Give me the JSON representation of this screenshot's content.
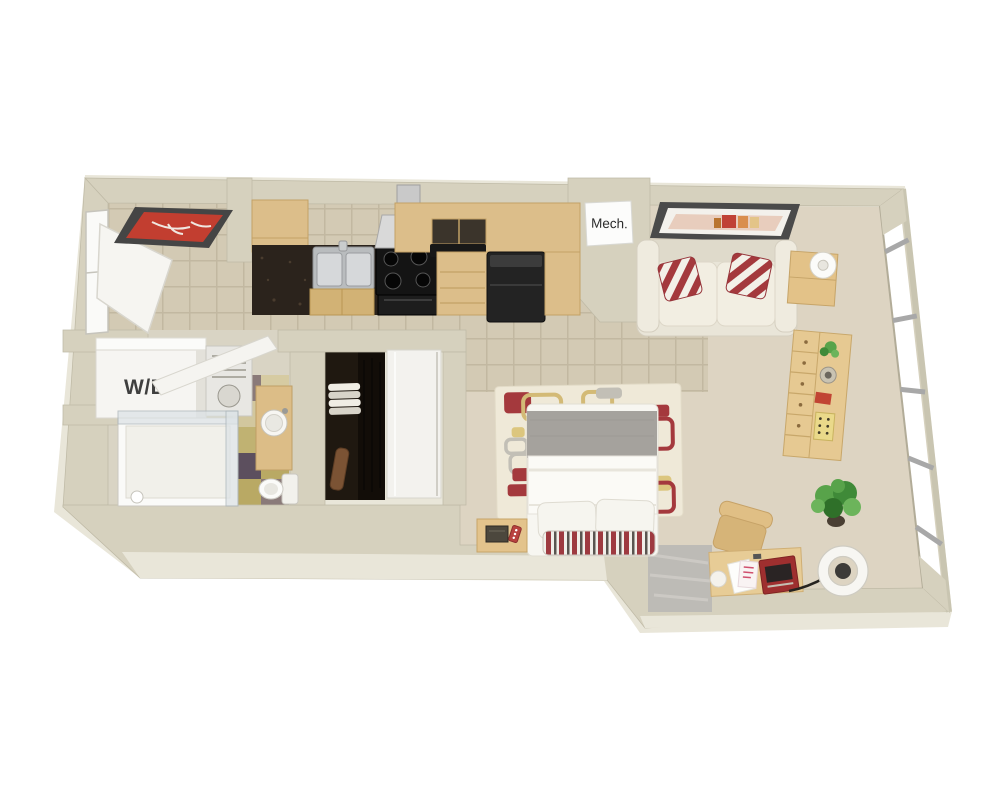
{
  "title": "3D studio apartment floor plan render",
  "labels": {
    "washer_dryer": "W/D",
    "mechanical": "Mech."
  },
  "palette": {
    "background": "#ffffff",
    "wall_top": "#d6d1be",
    "wall_face": "#e9e6d9",
    "carpet": "#ddd4c2",
    "tile": "#d3cab4",
    "tile_grout": "#c2b8a1",
    "granite_counter": "#2b231c",
    "cabinet_wood": "#dcbe8a",
    "appliance_black": "#232323",
    "stainless_steel": "#b9bcbe",
    "sofa_cream": "#e9e5d8",
    "pillow_red": "#a4393d",
    "art_red": "#c23e30",
    "rug_cream": "#efe9d8",
    "rug_tan": "#d3ba76",
    "bed_gray": "#a5a29d",
    "plant_green": "#58a34a",
    "concrete_patch": "#bdbbb6",
    "window_glass": "#ffffff",
    "window_frame": "#a8a8a8",
    "bath_tile_olive": "#b9a964",
    "bath_tile_plum": "#6f5d68"
  }
}
